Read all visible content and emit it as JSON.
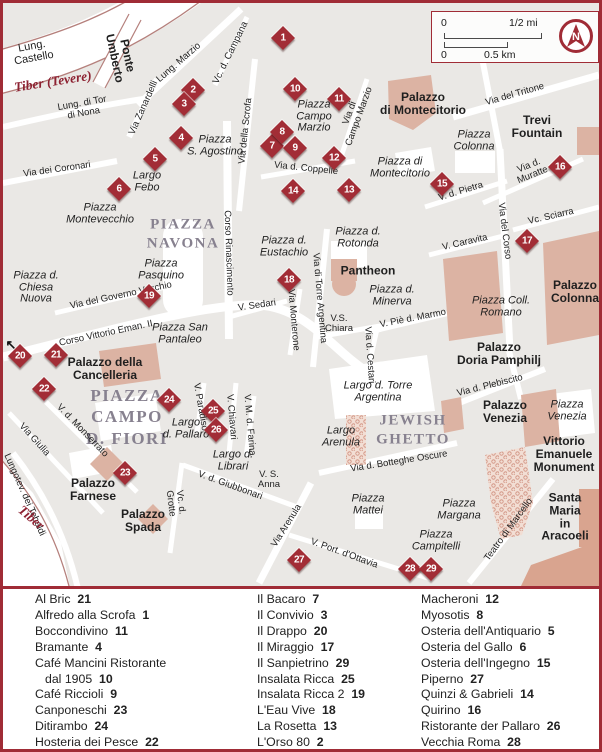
{
  "colors": {
    "accent": "#a02c36",
    "building": "#dcb3a3",
    "building_dark": "#d9a48f",
    "block": "#eae8e5",
    "river_edge": "#b5807c",
    "district_text": "#87818f",
    "marker": "#a22d36"
  },
  "scalebar": {
    "mi_zero": "0",
    "mi_label": "1/2 mi",
    "km_zero": "0",
    "km_label": "0.5 km",
    "compass_n": "N"
  },
  "map": {
    "labels": [
      {
        "t": "Lung.\nCastello",
        "x": 30,
        "y": 50,
        "r": -10,
        "s": "st",
        "fs": 11
      },
      {
        "t": "Tiber (Tevere)",
        "x": 50,
        "y": 79,
        "r": -9,
        "s": "rv"
      },
      {
        "t": "Ponte\nUmberto",
        "x": 118,
        "y": 54,
        "r": 78,
        "s": "lm"
      },
      {
        "t": "Lung. Marzio",
        "x": 176,
        "y": 60,
        "r": -41,
        "s": "st"
      },
      {
        "t": "Lung. di Tor\ndi Nona",
        "x": 80,
        "y": 106,
        "r": -10,
        "s": "st"
      },
      {
        "t": "Via Zanardelli",
        "x": 141,
        "y": 105,
        "r": -66,
        "s": "st"
      },
      {
        "t": "Vc. d. Campana",
        "x": 228,
        "y": 50,
        "r": -64,
        "s": "st"
      },
      {
        "t": "Via della Scrofa",
        "x": 243,
        "y": 128,
        "r": -84,
        "s": "st"
      },
      {
        "t": "Via dei Coronari",
        "x": 54,
        "y": 167,
        "r": -8,
        "s": "st"
      },
      {
        "t": "Piazza\nS. Agostino",
        "x": 212,
        "y": 143,
        "r": 0,
        "s": "pz"
      },
      {
        "t": "Largo\nFebo",
        "x": 144,
        "y": 179,
        "r": 0,
        "s": "pz"
      },
      {
        "t": "Piazza\nMontevecchio",
        "x": 97,
        "y": 211,
        "r": 0,
        "s": "pz"
      },
      {
        "t": "PIAZZA\nNAVONA",
        "x": 180,
        "y": 231,
        "r": 0,
        "s": "di"
      },
      {
        "t": "Corso Rinascimento",
        "x": 225,
        "y": 250,
        "r": 88,
        "s": "st"
      },
      {
        "t": "Piazza\nPasquino",
        "x": 158,
        "y": 267,
        "r": 0,
        "s": "pz"
      },
      {
        "t": "Via del Governo Vecchio",
        "x": 118,
        "y": 293,
        "r": -12,
        "s": "st"
      },
      {
        "t": "Corso Vittorio Eman. II",
        "x": 103,
        "y": 331,
        "r": -12,
        "s": "st"
      },
      {
        "t": "Piazza San\nPantaleo",
        "x": 177,
        "y": 331,
        "r": 0,
        "s": "pz"
      },
      {
        "t": "Piazza d.\nChiesa\nNuova",
        "x": 33,
        "y": 285,
        "r": 0,
        "s": "pz"
      },
      {
        "t": "Piazza\nCampo\nMarzio",
        "x": 311,
        "y": 114,
        "r": 0,
        "s": "pz"
      },
      {
        "t": "Via di\nCampo Marzio",
        "x": 352,
        "y": 112,
        "r": -70,
        "s": "st"
      },
      {
        "t": "Via d. Coppelle",
        "x": 303,
        "y": 166,
        "r": 6,
        "s": "st"
      },
      {
        "t": "Piazza di\nMontecitorio",
        "x": 397,
        "y": 165,
        "r": 0,
        "s": "pz"
      },
      {
        "t": "Palazzo\ndi Montecitorio",
        "x": 420,
        "y": 101,
        "r": 0,
        "s": "lm"
      },
      {
        "t": "Via del Tritone",
        "x": 512,
        "y": 92,
        "r": -16,
        "s": "st"
      },
      {
        "t": "Trevi\nFountain",
        "x": 534,
        "y": 124,
        "r": 0,
        "s": "lm"
      },
      {
        "t": "Piazza\nColonna",
        "x": 471,
        "y": 138,
        "r": 0,
        "s": "pz"
      },
      {
        "t": "Via d.\nMuratte",
        "x": 528,
        "y": 168,
        "r": -22,
        "s": "st"
      },
      {
        "t": "V. d. Pietra",
        "x": 458,
        "y": 189,
        "r": -17,
        "s": "st"
      },
      {
        "t": "Vc. Sciarra",
        "x": 548,
        "y": 214,
        "r": -13,
        "s": "st"
      },
      {
        "t": "V. Caravita",
        "x": 462,
        "y": 240,
        "r": -13,
        "s": "st"
      },
      {
        "t": "Via del Corso",
        "x": 501,
        "y": 228,
        "r": 83,
        "s": "st"
      },
      {
        "t": "Piazza d.\nEustachio",
        "x": 281,
        "y": 244,
        "r": 0,
        "s": "pz"
      },
      {
        "t": "Piazza d.\nRotonda",
        "x": 355,
        "y": 235,
        "r": 0,
        "s": "pz"
      },
      {
        "t": "Pantheon",
        "x": 365,
        "y": 268,
        "r": 0,
        "s": "lm"
      },
      {
        "t": "Piazza d.\nMinerva",
        "x": 389,
        "y": 293,
        "r": 0,
        "s": "pz"
      },
      {
        "t": "V. Piè d. Marmo",
        "x": 410,
        "y": 316,
        "r": -11,
        "s": "st"
      },
      {
        "t": "V.S.\nChiara",
        "x": 336,
        "y": 321,
        "r": 0,
        "s": "st"
      },
      {
        "t": "Piazza Coll.\nRomano",
        "x": 498,
        "y": 304,
        "r": 0,
        "s": "pz"
      },
      {
        "t": "Palazzo\nColonna",
        "x": 572,
        "y": 289,
        "r": 0,
        "s": "lm"
      },
      {
        "t": "V. Sedari",
        "x": 254,
        "y": 303,
        "r": -8,
        "s": "st"
      },
      {
        "t": "Via Monterone",
        "x": 290,
        "y": 317,
        "r": 85,
        "s": "st"
      },
      {
        "t": "Via di Torre Argentina",
        "x": 316,
        "y": 295,
        "r": 85,
        "s": "st"
      },
      {
        "t": "Via d. Cestari",
        "x": 366,
        "y": 352,
        "r": 86,
        "s": "st"
      },
      {
        "t": "Largo d. Torre\nArgentina",
        "x": 375,
        "y": 389,
        "r": 0,
        "s": "pz"
      },
      {
        "t": "Palazzo\nDoria Pamphilj",
        "x": 496,
        "y": 351,
        "r": 0,
        "s": "lm"
      },
      {
        "t": "Via d. Plebiscito",
        "x": 487,
        "y": 383,
        "r": -14,
        "s": "st"
      },
      {
        "t": "Palazzo\nVenezia",
        "x": 502,
        "y": 409,
        "r": 0,
        "s": "lm"
      },
      {
        "t": "Piazza\nVenezia",
        "x": 564,
        "y": 408,
        "r": 0,
        "s": "pz"
      },
      {
        "t": "Vittorio\nEmanuele\nMonument",
        "x": 561,
        "y": 451,
        "r": 0,
        "s": "lm"
      },
      {
        "t": "JEWISH\nGHETTO",
        "x": 410,
        "y": 427,
        "r": 0,
        "s": "di"
      },
      {
        "t": "Largo\nArenula",
        "x": 338,
        "y": 434,
        "r": 0,
        "s": "pz"
      },
      {
        "t": "Via d. Botteghe Oscure",
        "x": 396,
        "y": 459,
        "r": -9,
        "s": "st"
      },
      {
        "t": "PIAZZA\nCAMPO\nD. FIORI",
        "x": 124,
        "y": 414,
        "r": 0,
        "s": "di",
        "fs": 17
      },
      {
        "t": "Palazzo della\nCancelleria",
        "x": 102,
        "y": 366,
        "r": 0,
        "s": "lm"
      },
      {
        "t": "V. Paradiso",
        "x": 197,
        "y": 404,
        "r": 80,
        "s": "st"
      },
      {
        "t": "V. Chiavari",
        "x": 228,
        "y": 414,
        "r": 85,
        "s": "st"
      },
      {
        "t": "V. M. d. Farina",
        "x": 246,
        "y": 422,
        "r": 85,
        "s": "st"
      },
      {
        "t": "Largo\nd. Pallaro",
        "x": 183,
        "y": 426,
        "r": 0,
        "s": "pz"
      },
      {
        "t": "Largo d.\nLibrari",
        "x": 230,
        "y": 458,
        "r": 0,
        "s": "pz"
      },
      {
        "t": "V. d. Giubbonari",
        "x": 227,
        "y": 483,
        "r": 20,
        "s": "st"
      },
      {
        "t": "V. S.\nAnna",
        "x": 266,
        "y": 477,
        "r": 0,
        "s": "st"
      },
      {
        "t": "Vc. d.\nGrotte",
        "x": 172,
        "y": 500,
        "r": 83,
        "s": "st"
      },
      {
        "t": "V. d. Monserrato",
        "x": 79,
        "y": 428,
        "r": 46,
        "s": "st"
      },
      {
        "t": "Via Giulia",
        "x": 31,
        "y": 437,
        "r": 48,
        "s": "st"
      },
      {
        "t": "Lungotev. dei Tebaldi",
        "x": 21,
        "y": 492,
        "r": 66,
        "s": "st"
      },
      {
        "t": "Tiber",
        "x": 28,
        "y": 515,
        "r": 40,
        "s": "rv"
      },
      {
        "t": "Palazzo\nFarnese",
        "x": 90,
        "y": 487,
        "r": 0,
        "s": "lm"
      },
      {
        "t": "Palazzo\nSpada",
        "x": 140,
        "y": 518,
        "r": 0,
        "s": "lm"
      },
      {
        "t": "Via Arenula",
        "x": 284,
        "y": 523,
        "r": -58,
        "s": "st"
      },
      {
        "t": "V. Port. d'Ottavia",
        "x": 341,
        "y": 551,
        "r": 20,
        "s": "st"
      },
      {
        "t": "Piazza\nMattei",
        "x": 365,
        "y": 502,
        "r": 0,
        "s": "pz"
      },
      {
        "t": "Piazza\nMargana",
        "x": 456,
        "y": 507,
        "r": 0,
        "s": "pz"
      },
      {
        "t": "Piazza\nCampitelli",
        "x": 433,
        "y": 538,
        "r": 0,
        "s": "pz"
      },
      {
        "t": "Teatro di Marcello",
        "x": 506,
        "y": 527,
        "r": -54,
        "s": "st"
      },
      {
        "t": "Santa\nMaria\nin Aracoeli",
        "x": 562,
        "y": 514,
        "r": 0,
        "s": "lm"
      },
      {
        "t": "↖",
        "x": 8,
        "y": 342,
        "r": 0,
        "s": "ar"
      }
    ],
    "markers": [
      {
        "n": "1",
        "x": 280,
        "y": 35
      },
      {
        "n": "2",
        "x": 190,
        "y": 87
      },
      {
        "n": "3",
        "x": 181,
        "y": 101
      },
      {
        "n": "4",
        "x": 178,
        "y": 135
      },
      {
        "n": "5",
        "x": 152,
        "y": 156
      },
      {
        "n": "6",
        "x": 116,
        "y": 186
      },
      {
        "n": "7",
        "x": 269,
        "y": 143
      },
      {
        "n": "8",
        "x": 279,
        "y": 129
      },
      {
        "n": "9",
        "x": 292,
        "y": 145
      },
      {
        "n": "10",
        "x": 292,
        "y": 86
      },
      {
        "n": "11",
        "x": 336,
        "y": 96
      },
      {
        "n": "12",
        "x": 331,
        "y": 155
      },
      {
        "n": "13",
        "x": 346,
        "y": 187
      },
      {
        "n": "14",
        "x": 290,
        "y": 188
      },
      {
        "n": "15",
        "x": 439,
        "y": 181
      },
      {
        "n": "16",
        "x": 557,
        "y": 164
      },
      {
        "n": "17",
        "x": 524,
        "y": 238
      },
      {
        "n": "18",
        "x": 286,
        "y": 277
      },
      {
        "n": "19",
        "x": 146,
        "y": 293
      },
      {
        "n": "20",
        "x": 17,
        "y": 353
      },
      {
        "n": "21",
        "x": 53,
        "y": 352
      },
      {
        "n": "22",
        "x": 41,
        "y": 386
      },
      {
        "n": "23",
        "x": 122,
        "y": 470
      },
      {
        "n": "24",
        "x": 166,
        "y": 397
      },
      {
        "n": "25",
        "x": 210,
        "y": 408
      },
      {
        "n": "26",
        "x": 213,
        "y": 427
      },
      {
        "n": "27",
        "x": 296,
        "y": 557
      },
      {
        "n": "28",
        "x": 407,
        "y": 566
      },
      {
        "n": "29",
        "x": 428,
        "y": 566
      }
    ]
  },
  "legend": {
    "columns": [
      {
        "entries": [
          {
            "lines": [
              "Al Bric"
            ],
            "num": "21"
          },
          {
            "lines": [
              "Alfredo alla Scrofa"
            ],
            "num": "1"
          },
          {
            "lines": [
              "Boccondivino"
            ],
            "num": "11"
          },
          {
            "lines": [
              "Bramante"
            ],
            "num": "4"
          },
          {
            "lines": [
              "Café Mancini Ristorante",
              "dal 1905"
            ],
            "num": "10"
          },
          {
            "lines": [
              "Café Riccioli"
            ],
            "num": "9"
          },
          {
            "lines": [
              "Canponeschi"
            ],
            "num": "23"
          },
          {
            "lines": [
              "Ditirambo"
            ],
            "num": "24"
          },
          {
            "lines": [
              "Hosteria dei Pesce"
            ],
            "num": "22"
          }
        ]
      },
      {
        "entries": [
          {
            "lines": [
              "Il Bacaro"
            ],
            "num": "7"
          },
          {
            "lines": [
              "Il Convivio"
            ],
            "num": "3"
          },
          {
            "lines": [
              "Il Drappo"
            ],
            "num": "20"
          },
          {
            "lines": [
              "Il Miraggio"
            ],
            "num": "17"
          },
          {
            "lines": [
              "Il Sanpietrino"
            ],
            "num": "29"
          },
          {
            "lines": [
              "Insalata Ricca"
            ],
            "num": "25"
          },
          {
            "lines": [
              "Insalata Ricca 2"
            ],
            "num": "19"
          },
          {
            "lines": [
              "L'Eau Vive"
            ],
            "num": "18"
          },
          {
            "lines": [
              "La Rosetta"
            ],
            "num": "13"
          },
          {
            "lines": [
              "L'Orso 80"
            ],
            "num": "2"
          }
        ]
      },
      {
        "entries": [
          {
            "lines": [
              "Macheroni"
            ],
            "num": "12"
          },
          {
            "lines": [
              "Myosotis"
            ],
            "num": "8"
          },
          {
            "lines": [
              "Osteria dell'Antiquario"
            ],
            "num": "5"
          },
          {
            "lines": [
              "Osteria del Gallo"
            ],
            "num": "6"
          },
          {
            "lines": [
              "Osteria dell'Ingegno"
            ],
            "num": "15"
          },
          {
            "lines": [
              "Piperno"
            ],
            "num": "27"
          },
          {
            "lines": [
              "Quinzi & Gabrieli"
            ],
            "num": "14"
          },
          {
            "lines": [
              "Quirino"
            ],
            "num": "16"
          },
          {
            "lines": [
              "Ristorante der Pallaro"
            ],
            "num": "26"
          },
          {
            "lines": [
              "Vecchia Roma"
            ],
            "num": "28"
          }
        ]
      }
    ]
  }
}
